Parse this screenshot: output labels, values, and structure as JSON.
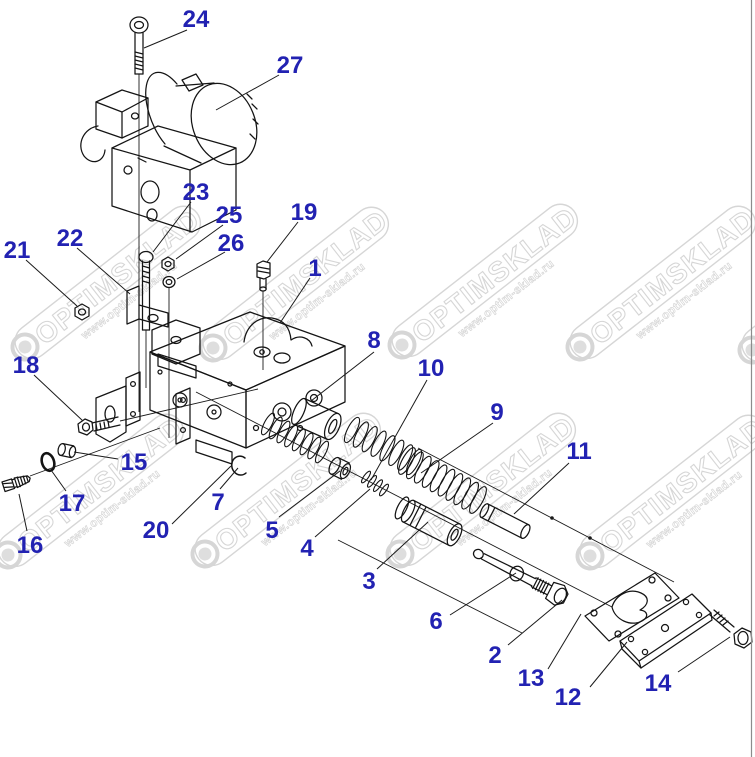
{
  "diagram": {
    "type": "exploded-parts-diagram",
    "label_color": "#2222b2",
    "line_color": "#141414",
    "border_color": "#8c8c8c",
    "callouts": [
      {
        "n": "24",
        "x": 196,
        "y": 18,
        "leader": [
          187,
          30,
          144,
          48
        ]
      },
      {
        "n": "27",
        "x": 290,
        "y": 64,
        "leader": [
          279,
          75,
          216,
          110
        ]
      },
      {
        "n": "23",
        "x": 196,
        "y": 191,
        "leader": [
          191,
          202,
          153,
          252
        ]
      },
      {
        "n": "25",
        "x": 229,
        "y": 214,
        "leader": [
          223,
          225,
          176,
          259
        ]
      },
      {
        "n": "26",
        "x": 231,
        "y": 242,
        "leader": [
          225,
          252,
          177,
          279
        ]
      },
      {
        "n": "19",
        "x": 304,
        "y": 211,
        "leader": [
          298,
          222,
          267,
          262
        ]
      },
      {
        "n": "1",
        "x": 315,
        "y": 267,
        "leader": [
          310,
          278,
          280,
          323
        ]
      },
      {
        "n": "22",
        "x": 70,
        "y": 237,
        "leader": [
          77,
          248,
          130,
          294
        ]
      },
      {
        "n": "21",
        "x": 17,
        "y": 249,
        "leader": [
          26,
          260,
          77,
          306
        ]
      },
      {
        "n": "18",
        "x": 26,
        "y": 364,
        "leader": [
          34,
          375,
          83,
          421
        ]
      },
      {
        "n": "8",
        "x": 374,
        "y": 339,
        "leader": [
          374,
          352,
          311,
          401
        ]
      },
      {
        "n": "10",
        "x": 431,
        "y": 367,
        "leader": [
          427,
          380,
          371,
          480
        ]
      },
      {
        "n": "9",
        "x": 497,
        "y": 411,
        "leader": [
          493,
          423,
          421,
          473
        ]
      },
      {
        "n": "11",
        "x": 579,
        "y": 450,
        "leader": [
          569,
          463,
          514,
          514
        ]
      },
      {
        "n": "15",
        "x": 134,
        "y": 461,
        "leader": [
          118,
          459,
          74,
          452
        ]
      },
      {
        "n": "17",
        "x": 72,
        "y": 502,
        "leader": [
          66,
          491,
          51,
          470
        ]
      },
      {
        "n": "16",
        "x": 30,
        "y": 544,
        "leader": [
          27,
          531,
          19,
          494
        ]
      },
      {
        "n": "20",
        "x": 156,
        "y": 529,
        "leader": [
          172,
          524,
          231,
          466
        ]
      },
      {
        "n": "7",
        "x": 218,
        "y": 501,
        "leader": [
          220,
          489,
          238,
          468
        ]
      },
      {
        "n": "5",
        "x": 272,
        "y": 529,
        "leader": [
          279,
          517,
          340,
          471
        ]
      },
      {
        "n": "4",
        "x": 307,
        "y": 547,
        "leader": [
          315,
          537,
          370,
          489
        ]
      },
      {
        "n": "3",
        "x": 369,
        "y": 580,
        "leader": [
          377,
          569,
          428,
          522
        ]
      },
      {
        "n": "6",
        "x": 436,
        "y": 620,
        "leader": [
          450,
          615,
          516,
          573
        ]
      },
      {
        "n": "2",
        "x": 495,
        "y": 654,
        "leader": [
          508,
          645,
          562,
          600
        ]
      },
      {
        "n": "13",
        "x": 531,
        "y": 677,
        "leader": [
          548,
          669,
          581,
          614
        ]
      },
      {
        "n": "12",
        "x": 568,
        "y": 696,
        "leader": [
          590,
          687,
          627,
          642
        ]
      },
      {
        "n": "14",
        "x": 658,
        "y": 682,
        "leader": [
          678,
          672,
          730,
          637
        ]
      }
    ]
  },
  "watermark": {
    "brand": "OPTIMSKLAD",
    "url": "www.optim-sklad.ru",
    "angle": -38,
    "color": "#d6d6d6",
    "text_fill": "#ffffff",
    "ring_positions": [
      [
        25,
        347
      ],
      [
        213,
        348
      ],
      [
        402,
        345
      ],
      [
        580,
        347
      ],
      [
        752,
        350
      ],
      [
        8,
        555
      ],
      [
        205,
        554
      ],
      [
        400,
        554
      ],
      [
        590,
        556
      ]
    ]
  }
}
